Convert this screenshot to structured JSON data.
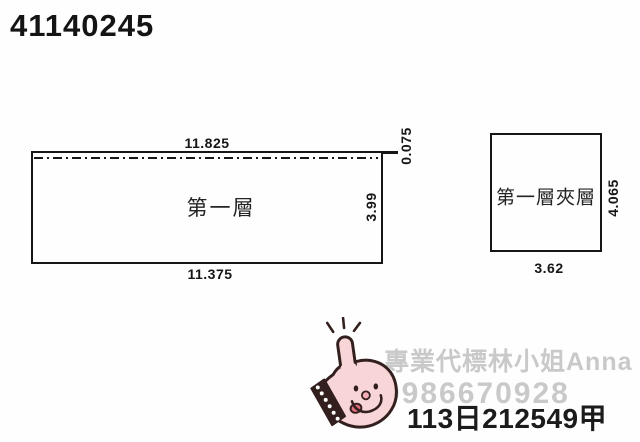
{
  "document_number": "41140245",
  "floor_plan": {
    "main_room": {
      "label": "第一層",
      "dim_top": "11.825",
      "dim_bottom": "11.375",
      "dim_right": "3.99",
      "dim_offset": "0.075"
    },
    "mezzanine": {
      "label": "第一層夾層",
      "dim_bottom": "3.62",
      "dim_right": "4.065"
    }
  },
  "watermark": {
    "agent_line": "專業代標林小姐Anna",
    "phone_line": "0986670928"
  },
  "case_number": "113日212549甲",
  "icons": {
    "stamp": "thumbs-up-hand-stamp"
  },
  "colors": {
    "line": "#161616",
    "stamp_pink": "#f8d5d6",
    "stamp_outline": "#33201e",
    "stamp_tongue": "#e2717e",
    "watermark_gray": "#c9c9c9"
  }
}
